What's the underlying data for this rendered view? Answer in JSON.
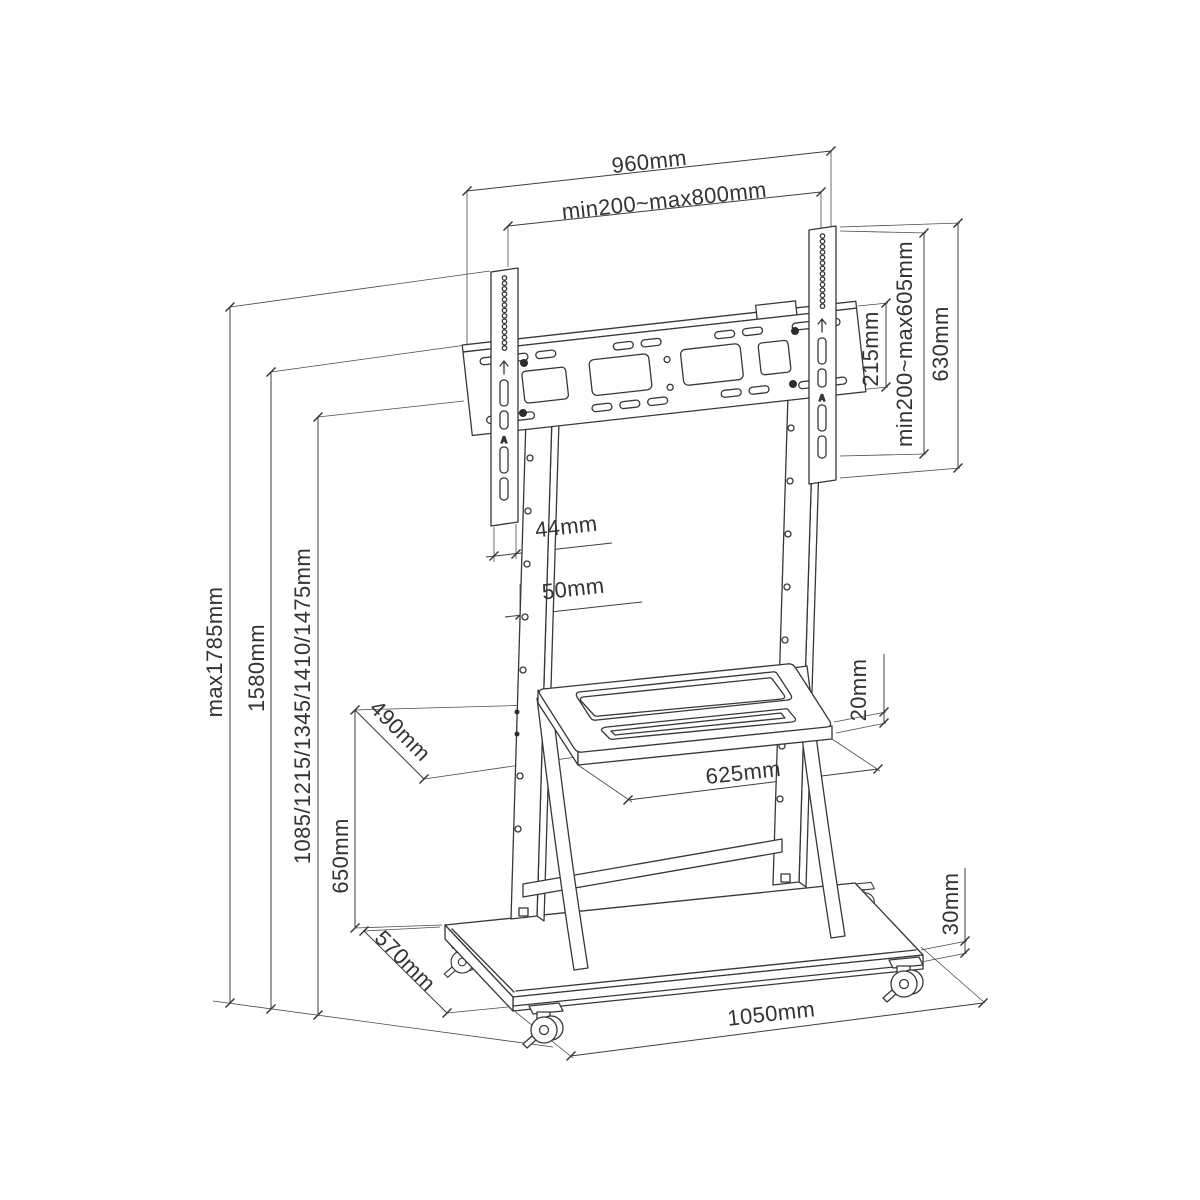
{
  "diagram": {
    "title": "Mobile TV trolley stand — dimension drawing",
    "units": "mm",
    "line_color": "#373737",
    "background_color": "#ffffff",
    "dims": {
      "top_width": "960mm",
      "vesa_width": "min200~max800mm",
      "bracket_height": "215mm",
      "vesa_height": "min200~max605mm",
      "rail_height": "630mm",
      "rail_width": "44mm",
      "column_width": "50mm",
      "max_height": "max1785mm",
      "column_top_height": "1580mm",
      "bracket_positions": "1085/1215/1345/1410/1475mm",
      "shelf_height": "650mm",
      "shelf_depth": "490mm",
      "shelf_thickness": "20mm",
      "shelf_width": "625mm",
      "base_depth": "570mm",
      "base_thickness": "30mm",
      "base_width": "1050mm"
    },
    "rail_badge": "A"
  }
}
